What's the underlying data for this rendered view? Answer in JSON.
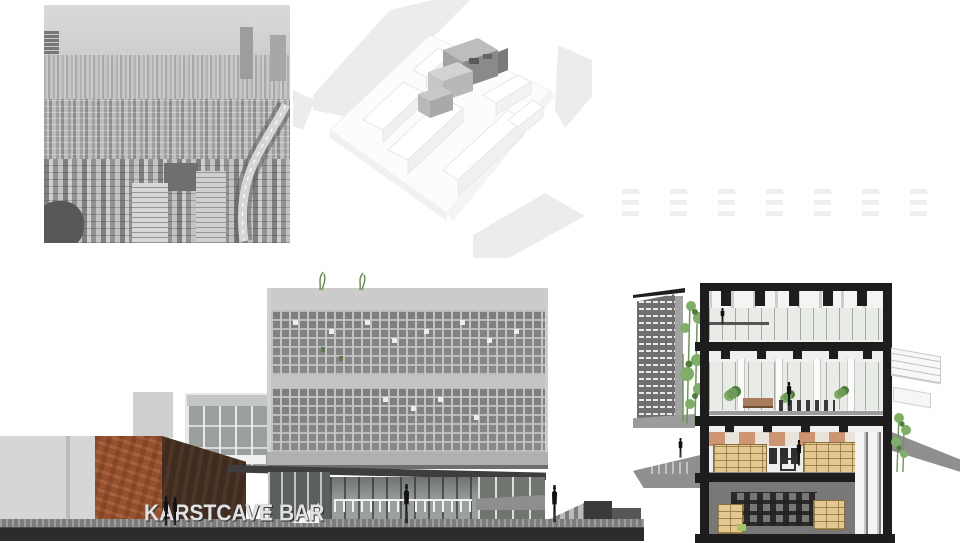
{
  "board": {
    "background": "#ffffff",
    "panels": {
      "context_photo": "black-and-white aerial photograph of dense urban fabric",
      "site_axon": "white site massing axonometric with gray infill building cluster",
      "street_elevation": "street elevation: corten volume, glass atrium, waffle-grid concrete tower",
      "sectional_perspective": "cut-away sectional perspective with library shelving and planted screen wall"
    }
  },
  "elevation": {
    "signage_text": "KARSTCAVE BAR"
  },
  "palette": {
    "photo_sky": "#d7d7d7",
    "axon_road": "#ebebeb",
    "axon_mass_gray": "#9a9a9a",
    "concrete_light": "#cbcbcb",
    "waffle_cell": "#7f7f7f",
    "corten_front": "#96512c",
    "corten_side": "#3f2b1f",
    "glass_gray": "#9aa09b",
    "canopy_dark": "#3e3e3e",
    "base_dark": "#2c2c2c",
    "section_poche": "#1d1d1d",
    "ground_plane": "#8f8f8f",
    "shelf_tan": "#e5c88f",
    "plant_green": "#6f9a52",
    "warm_reflection": "#c9855d"
  },
  "ghost_pattern": {
    "columns": 7,
    "rows": 3
  }
}
